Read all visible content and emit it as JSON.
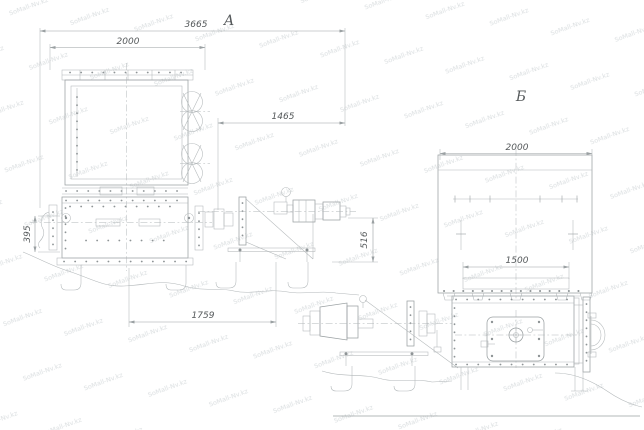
{
  "watermark": {
    "text": "SoMall-Nv.kz"
  },
  "colors": {
    "background": "#ffffff",
    "line": "#9aa0a2",
    "line_light": "#b2b7b9",
    "bolt": "#8e9496",
    "dim_text": "#55595b",
    "watermark": "#dadee0"
  },
  "view_a": {
    "label": "А",
    "dimensions": {
      "overall_length": "3665",
      "hopper_width": "2000",
      "drive_length": "1465",
      "inlet_height": "395",
      "axis_height": "516",
      "base_length": "1759"
    }
  },
  "view_b": {
    "label": "Б",
    "dimensions": {
      "body_width": "2000",
      "outlet_width": "1500"
    }
  }
}
